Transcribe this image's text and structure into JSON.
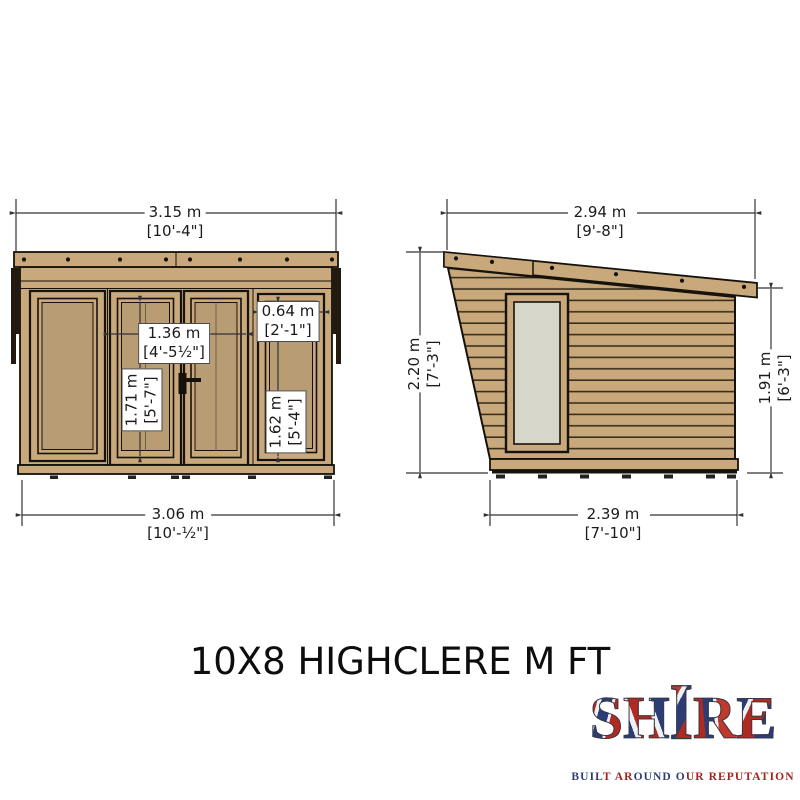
{
  "title": "10X8 HIGHCLERE M FT",
  "front_view": {
    "dims": {
      "width_top": {
        "metric": "3.15 m",
        "imperial": "[10'-4\"]"
      },
      "width_bottom": {
        "metric": "3.06 m",
        "imperial": "[10'-½\"]"
      },
      "door_width": {
        "metric": "1.36 m",
        "imperial": "[4'-5½\"]"
      },
      "door_height": {
        "metric": "1.71 m",
        "imperial": "[5'-7\"]"
      },
      "window_width": {
        "metric": "0.64 m",
        "imperial": "[2'-1\"]"
      },
      "window_height": {
        "metric": "1.62 m",
        "imperial": "[5'-4\"]"
      }
    }
  },
  "side_view": {
    "dims": {
      "depth_top": {
        "metric": "2.94 m",
        "imperial": "[9'-8\"]"
      },
      "depth_bottom": {
        "metric": "2.39 m",
        "imperial": "[7'-10\"]"
      },
      "height_left": {
        "metric": "2.20 m",
        "imperial": "[7'-3\"]"
      },
      "height_right": {
        "metric": "1.91 m",
        "imperial": "[6'-3\"]"
      }
    }
  },
  "logo": {
    "letters": [
      "S",
      "H",
      "I",
      "R",
      "E"
    ],
    "tagline": "BUILT AROUND OUR REPUTATION"
  },
  "colors": {
    "wood": "#C9A87B",
    "glazing_front": "#B89C74",
    "glass_side": "#D7D6CB",
    "outline": "#15120C",
    "dimension": "#333333",
    "logo_red": "#B12A20",
    "logo_blue": "#2B3C77"
  }
}
